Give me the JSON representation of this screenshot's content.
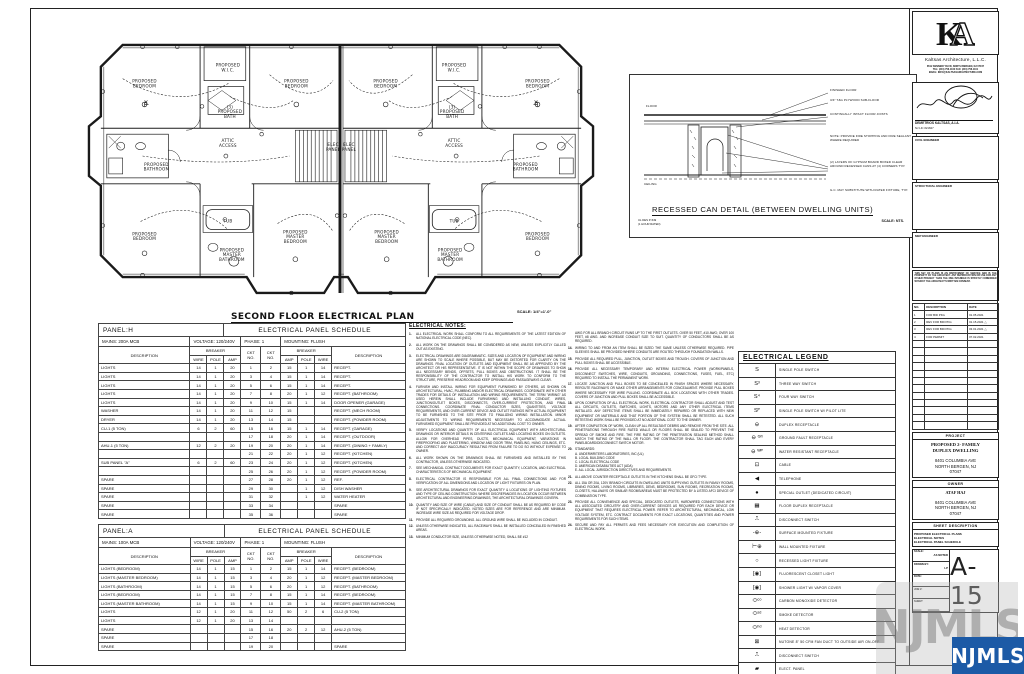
{
  "plan": {
    "title": "SECOND FLOOR ELECTRICAL PLAN",
    "scale": "SCALE: 1/4\"=1'-0\"",
    "labels": [
      {
        "t": "PROPOSED\nBEDROOM",
        "x": 62,
        "y": 66,
        "m": 1
      },
      {
        "t": "PROPOSED\nW.I.C.",
        "x": 146,
        "y": 50,
        "m": 1
      },
      {
        "t": "(3)\nPROPOSED\nBATH",
        "x": 148,
        "y": 92,
        "m": 1
      },
      {
        "t": "PROPOSED\nBEDROOM",
        "x": 215,
        "y": 66,
        "m": 1
      },
      {
        "t": "ATTIC\nACCESS",
        "x": 146,
        "y": 126,
        "m": 1
      },
      {
        "t": "PROPOSED\nBATHROOM",
        "x": 74,
        "y": 150,
        "m": 1
      },
      {
        "t": "ELEC\nPANEL",
        "x": 252,
        "y": 130,
        "m": 1
      },
      {
        "t": "PROPOSED\nBEDROOM",
        "x": 62,
        "y": 220,
        "m": 1
      },
      {
        "t": "TUB",
        "x": 146,
        "y": 207,
        "m": 1
      },
      {
        "t": "PROPOSED\nMASTER\nBATHROOM",
        "x": 150,
        "y": 236,
        "m": 1
      },
      {
        "t": "PROPOSED\nMASTER\nBEDROOM",
        "x": 214,
        "y": 218,
        "m": 1
      }
    ]
  },
  "panels": {
    "h": {
      "name": "PANEL:H",
      "title": "ELECTRICAL PANEL SCHEDULE",
      "mains": "MAINS: 200A MCB",
      "voltage": "VOLTAGE: 120/240V",
      "phase": "PHASE: 1",
      "mounting": "MOUNTING: FLUSH",
      "rows": [
        [
          "LIGHTS",
          "14",
          "1",
          "20",
          "1",
          "2",
          "15",
          "1",
          "14",
          "RECEPT."
        ],
        [
          "LIGHTS",
          "14",
          "1",
          "20",
          "3",
          "4",
          "15",
          "1",
          "14",
          "RECEPT."
        ],
        [
          "LIGHTS",
          "14",
          "1",
          "20",
          "5",
          "6",
          "15",
          "1",
          "14",
          "RECEPT."
        ],
        [
          "LIGHTS",
          "14",
          "1",
          "20",
          "7",
          "8",
          "20",
          "1",
          "12",
          "RECEPT. (BATHROOM)"
        ],
        [
          "LIGHTS",
          "14",
          "1",
          "20",
          "9",
          "10",
          "15",
          "1",
          "14",
          "DOOR OPENER (GARAGE)"
        ],
        [
          "WASHER",
          "14",
          "1",
          "20",
          "11",
          "12",
          "15",
          "",
          "",
          "RECEPT. (MECH ROOM)"
        ],
        [
          "DRYER",
          "14",
          "1",
          "20",
          "13",
          "14",
          "15",
          "",
          "",
          "RECEPT. (POWDER ROOM)"
        ],
        [
          "CU-1 (5 TON)",
          "6",
          "2",
          "60",
          "15",
          "16",
          "15",
          "1",
          "14",
          "RECEPT. (GARAGE)"
        ],
        [
          "",
          "",
          "",
          "",
          "17",
          "18",
          "20",
          "1",
          "14",
          "RECEPT. (OUTDOOR)"
        ],
        [
          "AHU-1 (5 TON)",
          "12",
          "2",
          "20",
          "19",
          "20",
          "20",
          "1",
          "14",
          "RECEPT. (DINING + FAMILY)"
        ],
        [
          "",
          "",
          "",
          "",
          "21",
          "22",
          "20",
          "1",
          "12",
          "RECEPT. (KITCHEN)"
        ],
        [
          "SUB PANEL \"A\"",
          "6",
          "2",
          "60",
          "23",
          "24",
          "20",
          "1",
          "12",
          "RECEPT. (KITCHEN)"
        ],
        [
          "",
          "",
          "",
          "",
          "25",
          "26",
          "20",
          "1",
          "12",
          "RECEPT. (POWDER ROOM)"
        ],
        [
          "SPARE",
          "",
          "",
          "",
          "27",
          "28",
          "20",
          "1",
          "12",
          "REF."
        ],
        [
          "SPARE",
          "",
          "",
          "",
          "29",
          "30",
          "",
          "1",
          "12",
          "DISH WASHER"
        ],
        [
          "SPARE",
          "",
          "",
          "",
          "31",
          "32",
          "",
          "1",
          "12",
          "WATER HEATER"
        ],
        [
          "SPARE",
          "",
          "",
          "",
          "33",
          "34",
          "",
          "",
          "",
          "SPARE"
        ],
        [
          "SPARE",
          "",
          "",
          "",
          "35",
          "36",
          "",
          "",
          "",
          "SPARE"
        ]
      ]
    },
    "a": {
      "name": "PANEL:A",
      "title": "ELECTRICAL PANEL SCHEDULE",
      "mains": "MAINS: 100A MCB",
      "voltage": "VOLTAGE: 120/240V",
      "phase": "PHASE: 1",
      "mounting": "MOUNTING: FLUSH",
      "rows": [
        [
          "LIGHTS (BEDROOM)",
          "14",
          "1",
          "15",
          "1",
          "2",
          "15",
          "1",
          "14",
          "RECEPT. (BEDROOM)"
        ],
        [
          "LIGHTS (MASTER BEDROOM)",
          "14",
          "1",
          "15",
          "3",
          "4",
          "20",
          "1",
          "12",
          "RECEPT. (MASTER BEDROOM)"
        ],
        [
          "LIGHTS (BATHROOM)",
          "14",
          "1",
          "15",
          "5",
          "6",
          "20",
          "1",
          "12",
          "RECEPT. (BATHROOM)"
        ],
        [
          "LIGHTS (BEDROOM)",
          "14",
          "1",
          "15",
          "7",
          "8",
          "15",
          "1",
          "14",
          "RECEPT. (BEDROOM)"
        ],
        [
          "LIGHTS (MASTER BATHROOM)",
          "14",
          "1",
          "15",
          "9",
          "10",
          "15",
          "1",
          "14",
          "RECEPT. (MASTER BATHROOM)"
        ],
        [
          "LIGHTS",
          "12",
          "1",
          "20",
          "11",
          "12",
          "50",
          "2",
          "6",
          "CU-2 (5 TON)"
        ],
        [
          "LIGHTS",
          "12",
          "1",
          "20",
          "13",
          "14",
          "",
          "",
          "",
          ""
        ],
        [
          "SPARE",
          "",
          "",
          "",
          "15",
          "16",
          "20",
          "2",
          "12",
          "AHU-2 (5 TON)"
        ],
        [
          "SPARE",
          "",
          "",
          "",
          "17",
          "18",
          "",
          "",
          "",
          ""
        ],
        [
          "SPARE",
          "",
          "",
          "",
          "19",
          "20",
          "",
          "",
          "",
          "SPARE"
        ]
      ]
    },
    "col_headers": {
      "description": "DESCRIPTION",
      "breaker": "BREAKER",
      "ckt": "CKT\nNO.",
      "wire": "WIRE",
      "pole": "POLE",
      "amp": "AMP"
    }
  },
  "notes": {
    "heading": "ELECTRICAL NOTES:",
    "col1": [
      {
        "n": "1.",
        "t": "ALL ELECTRICAL WORK SHALL CONFORM TO ALL REQUIREMENTS OF THE LATEST EDITION OF NATIONAL ELECTRICAL CODE (NEC)."
      },
      {
        "n": "2.",
        "t": "ALL WORK ON THE DRAWINGS SHALL BE CONSIDERED AS NEW, UNLESS EXPLICITLY CALLED OUT AS EXISTING."
      },
      {
        "n": "3.",
        "t": "ELECTRICAL DRAWINGS ARE DIAGRAMMATIC. SIZES AND LOCATION OF EQUIPMENT AND WIRING ARE SHOWN TO SCALE WHERE POSSIBLE, BUT MAY BE DISTORTED FOR CLARITY ON THE DRAWINGS. FINAL LOCATION OF OUTLETS AND EQUIPMENT SHALL BE AS APPROVED BY THE ARCHITECT OR HIS REPRESENTATIVE. IT IS NOT WITHIN THE SCOPE OF DRAWINGS TO SHOW ALL NECESSARY BENDS, OFFSETS, PULL BOXES AND OBSTRUCTIONS. IT SHALL BE THE RESPONSIBILITY OF THE CONTRACTOR TO INSTALL HIS WORK TO CONFORM TO THE STRUCTURE, PRESERVE HEADROOM AND KEEP OPENINGS AND PASSAGEWAYS CLEAR."
      },
      {
        "n": "4.",
        "t": "FURNISH AND INSTALL WIRING FOR EQUIPMENT FURNISHED BY OTHERS, AS SHOWN ON ARCHITECTURAL, HVAC, PLUMBING AND/OR ELECTRICAL DRAWINGS. COORDINATE WITH OTHER TRADES FOR DETAILS OF INSTALLATION AND WIRING REQUIREMENTS. THE TERM \"WIRING\" AS USED HEREIN SHALL INCLUDE FURNISHING AND INSTALLING CONDUIT, WIRES, JUNCTION/OUTLET BOXES, DISCONNECTS, OVER-CURRENT PROTECTION, AND FINAL CONNECTIONS. COORDINATE FINAL CONDUCTOR SIZES, QUANTITIES, VOLTAGE REQUIREMENTS, AND OVER-CURRENT DEVICE AND OUTLET RATINGS WITH ACTUAL EQUIPMENT TO BE FURNISHED TO THE SITE PRIOR TO FINALIZING WIRING INSTALLATION. MINOR ADJUSTMENTS TO WIRING REQUIREMENTS NECESSARY TO ACCOMMODATE ACTUAL FURNISHED EQUIPMENT SHALL BE PROVIDED AT NO ADDITIONAL COST TO OWNER."
      },
      {
        "n": "5.",
        "t": "VERIFY LOCATIONS AND QUANTITY OF ALL ELECTRICAL EQUIPMENT WITH ARCHITECTURAL DRAWINGS OR INTERIOR DETAILS IN CENTERING OUTLETS AND LOCATING BOXES ON OUTLETS. ALLOW FOR OVERHEAD PIPES, DUCTS, MECHANICAL EQUIPMENT, VARIATIONS IN FIREPROOFING AND PLASTERING, WINDOW AND DOOR TRIM, PANELING, HUNG CEILINGS, ETC. AND CORRECT ANY INACCURACY RESULTING FROM FAILURE TO DO SO WITHOUT EXPENSE TO OWNER."
      },
      {
        "n": "6.",
        "t": "ALL WORK SHOWN ON THE DRAWINGS SHALL BE FURNISHED AND INSTALLED BY THIS CONTRACTOR, UNLESS OTHERWISE INDICATED."
      },
      {
        "n": "7.",
        "t": "SEE MECHANICAL CONTRACT DOCUMENTS FOR EXACT QUANTITY, LOCATION, AND ELECTRICAL CHARACTERISTICS OF MECHANICAL EQUIPMENT."
      },
      {
        "n": "8.",
        "t": "ELECTRICAL CONTRACTOR IS RESPONSIBLE FOR ALL FINAL CONNECTIONS AND FOR VERIFICATION OF ALL DIMENSIONS AND LOCATION OF LIGHT FIXTURES ON PLAN."
      },
      {
        "n": "9.",
        "t": "SEE ARCHITECTURAL DRAWINGS FOR EXACT QUANTITY & LOCATIONS OF LIGHTING FIXTURES AND TYPE OF CEILING CONSTRUCTION. WHERE DISCREPANCIES IN LOCATION OCCUR BETWEEN ARCHITECTURAL AND ENGINEERING DRAWINGS, THE ARCHITECTURAL DRAWINGS GOVERN."
      },
      {
        "n": "10.",
        "t": "QUANTITY AND SIZE OF WIRE (CABLE) AND SIZE OF CONDUIT SHALL BE AS REQUIRED BY CODE IF NOT SPECIFICALLY INDICATED. NOTED SIZES ARE FOR REFERENCE AND ARE MINIMUM. INCREASE WIRE SIZE AS REQUIRED FOR VOLTAGE DROP."
      },
      {
        "n": "11.",
        "t": "PROVIDE ALL REQUIRED GROUNDING. ALL GROUND WIRE SHALL BE INCLUDED IN CONDUIT."
      },
      {
        "n": "12.",
        "t": "UNLESS OTHERWISE INDICATED, ALL RACEWAYS SHALL BE INSTALLED CONCEALED IN FINISHED AREAS."
      },
      {
        "n": "13.",
        "t": "MINIMUM CONDUCTOR SIZE, UNLESS OTHERWISE NOTED, SHALL BE #12"
      }
    ],
    "col2": [
      {
        "n": "",
        "t": "AWG FOR ALL BRANCH CIRCUIT RUNS UP TO THE FIRST OUTLETS. OVER 50 FEET, #10 AWG; OVER 100 FEET, #8 AWG. AND INCREASE CONDUIT SIZE TO SUIT. QUANTITY OF CONDUCTORS SHALL BE AS REQUIRED."
      },
      {
        "n": "14.",
        "t": "WIRING TO AND FROM AN ITEM SHALL BE SIZED THE SAME UNLESS OTHERWISE REQUIRED. PIPE SLEEVES SHALL BE PROVIDED WHERE CONDUITS ARE ROUTED THROUGH FOUNDATION WALLS."
      },
      {
        "n": "15.",
        "t": "PROVIDE ALL REQUIRED PULL, JUNCTION, OUTLET BOXES AND TROUGH. COVERS OF JUNCTION AND PULL BOXES SHALL BE ACCESSIBLE."
      },
      {
        "n": "16.",
        "t": "PROVIDE ALL NECESSARY TEMPORARY AND INTERIM ELECTRICAL POWER (WORK/PANELS, DISCONNECT SWITCHES, WIRE, CONDUITS, GROUNDING, CONNECTIONS, FUSES, FUEL, ETC) REQUIRED TO INSTALL THE PERMANENT WORK."
      },
      {
        "n": "17.",
        "t": "LOCATE JUNCTION AND PULL BOXES TO BE CONCEALED IN FINISH SPACES WHERE NECESSARY. REROUTE RACEWAYS OR MAKE OTHER ARRANGEMENTS FOR CONCEALMENT. PROVIDE PULL BOXES WHERE NECESSARY FOR WIRE PULLING. COORDINATE ALL BOX LOCATIONS WITH OTHER TRADES. COVERS OF JUNCTION AND PULL BOXES SHALL BE ACCESSIBLE."
      },
      {
        "n": "18.",
        "t": "UPON COMPLETION OF ALL ELECTRICAL WORK, ELECTRICAL CONTRACTOR SHALL ADJUST AND TEST ALL CIRCUITS, OUTLETS, SWITCHES, LIGHTS, MOTORS AND ANY OTHER ELECTRICAL ITEMS INSTALLED. ANY DEFECTIVE ITEMS SHALL BE IMMEDIATELY REPAIRED OR REPLACED WITH NEW EQUIPMENT OR MATERIALS AND THAT PORTION OF THE SYSTEM SHALL BE RETESTED. ALL SUCH RETESTING WORK SHALL BE PROVIDED AT NO ADDITIONAL COST TO THE OWNER."
      },
      {
        "n": "19.",
        "t": "AFTER COMPLETION OF WORK, CLEAN UP ALL RESULTANT DEBRIS AND REMOVE FROM THE SITE. ALL PENETRATIONS THROUGH FIRE RATED WALLS OR FLOORS SHALL BE SEALED TO PREVENT THE SPREAD OF SMOKE AND FIRE. THE FIRE RATING OF THE PENETRATION SEALING METHOD SHALL MATCH THE RATING OF THE WALL OR FLOOR. THE CONTRACTOR SHALL TAG EACH AND EVERY PANELBOARD/DISCONNECT SWITCH MOTOR."
      },
      {
        "n": "20.",
        "t": "STANDARDS:\nA. UNDERWRITERS LABORATORIES, INC (UL)\nB. LOCAL BUILDING CODE\nC. LOCAL ELECTRICAL CODE\nD. AMERICAN DISABILITIES ACT (ADA)\nE. ALL LOCAL JURISDICTION DIRECTIVES AND REQUIREMENTS."
      },
      {
        "n": "21.",
        "t": "ALL ABOVE COUNTER RECEPTACLE OUTLETS IN THE KITCHENS SHALL BE GFCI TYPE."
      },
      {
        "n": "22.",
        "t": "ALL 15A OR 20A, 120V BRANCH CIRCUITS IN DWELLING UNITS SUPPLYING OUTLETS IN FAMILY ROOMS, DINING ROOMS, LIVING ROOMS, LIBRARIES, DENS, BEDROOMS, SUN ROOMS, RECREATION ROOMS, CLOSETS, HALLWAYS OR SIMILAR ROOMS/AREAS MUST BE PROTECTED BY A LISTED AFCI DEVICE OF COMBINATION TYPE."
      },
      {
        "n": "23.",
        "t": "PROVIDE ALL CONVENIENCE AND SPECIAL, DEDICATED OUTLETS, HARDWIRED CONNECTIONS WITH ALL ASSOCIATED CIRCUITRY AND OVER-CURRENT DEVICES AS REQUIRED FOR EACH DEVICE OR EQUIPMENT THAT REQUIRES ELECTRICAL POWER. REFER TO ARCHITECTURAL, MECHANICAL, LOW VOLTAGE SYSTEM, ETC. CONTRACT DOCUMENTS FOR EXACT LOCATIONS, QUANTITIES AND POWER REQUIREMENTS FOR SUCH ITEMS."
      },
      {
        "n": "24.",
        "t": "SECURE AND PAY ALL PERMITS AND FEES NECESSARY FOR EXECUTION AND COMPLETION OF ELECTRICAL WORK."
      }
    ]
  },
  "legend": {
    "title": "ELECTRICAL LEGEND",
    "items": [
      {
        "sym": "S",
        "label": "SINGLE POLE SWITCH"
      },
      {
        "sym": "S³",
        "label": "THREE WAY SWITCH"
      },
      {
        "sym": "S⁴",
        "label": "FOUR WAY SWITCH"
      },
      {
        "sym": "Sᴾ",
        "label": "SINGLE POLE SWITCH W/ PILOT LITE"
      },
      {
        "sym": "⊖",
        "label": "DUPLEX RECEPTACLE"
      },
      {
        "sym": "⊖ ᴳᶠᴵ",
        "label": "GROUND FAULT RECEPTACLE"
      },
      {
        "sym": "⊖ ᵂᴾ",
        "label": "WATER RESISTANT RECEPTACLE"
      },
      {
        "sym": "⊡",
        "label": "CABLE"
      },
      {
        "sym": "◀",
        "label": "TELEPHONE"
      },
      {
        "sym": "●",
        "label": "SPECIAL OUTLET (DEDICATED CIRCUIT)"
      },
      {
        "sym": "▦",
        "label": "FLOOR DUPLEX RECEPTACLE"
      },
      {
        "sym": "⎍",
        "label": "DISCONNECT SWITCH"
      },
      {
        "sym": "-⊕-",
        "label": "SURFACE MOUNTED FIXTURE"
      },
      {
        "sym": "⊢⊕",
        "label": "WALL MOUNTED FIXTURE"
      },
      {
        "sym": "○",
        "label": "RECESSED LIGHT FIXTURE"
      },
      {
        "sym": "[◉]",
        "label": "FLUORESCENT CLOSET LIGHT"
      },
      {
        "sym": "[◉]",
        "label": "SHOWER LIGHT W/ VAPOR COVER"
      },
      {
        "sym": "⬭ᶜᵒ",
        "label": "CARBON MONOXIDE DETECTOR"
      },
      {
        "sym": "⬭ˢᵈ",
        "label": "SMOKE DETECTOR"
      },
      {
        "sym": "⬭ʰᵈ",
        "label": "HEAT DETECTOR"
      },
      {
        "sym": "⊠",
        "label": "NUTONE 8\" 50 CFM FAN DUCT TO OUTSIDE AIR ON-OFF"
      },
      {
        "sym": "⎍",
        "label": "DISCONNECT SWITCH"
      },
      {
        "sym": "▰",
        "label": "ELECT. PANEL"
      }
    ]
  },
  "detail": {
    "title": "RECESSED CAN DETAIL (BETWEEN DWELLING UNITS)",
    "scale": "SCALE: NTS.",
    "ul_note": "UL DES P-549\n(1 HOUR RATED)",
    "callouts": [
      {
        "t": "FINISHED FLOOR",
        "x": 200,
        "y": 14,
        "w": 82
      },
      {
        "t": "3/4\" T&G PLYWOOD SUB-FLOOR",
        "x": 200,
        "y": 24,
        "w": 82
      },
      {
        "t": "CONTINUALLY INTACT FLOOR JOISTS",
        "x": 200,
        "y": 38,
        "w": 82
      },
      {
        "t": "NOTE: PROVIDE FIRE STOPPING AND FIRE SEALANT WHERE REQUIRED",
        "x": 200,
        "y": 60,
        "w": 82
      },
      {
        "t": "(2) LAYERS OF GYPSUM BOARD BOXED CLEAR AROUND RECESSED CANS AT (4) CORNERS TYP.",
        "x": 200,
        "y": 86,
        "w": 82
      },
      {
        "t": "G.C. MAY SUBSTITUTE WITH RATED FIXTURE, TYP.",
        "x": 200,
        "y": 114,
        "w": 82
      },
      {
        "t": "FLOOR",
        "x": 16,
        "y": 30,
        "w": 30
      },
      {
        "t": "CEILING",
        "x": 14,
        "y": 108,
        "w": 30
      }
    ]
  },
  "titleblock": {
    "firm": "Kaltsas Architecture, L.L.C.",
    "contact": "8512 KENNEDY BLVD, NORTH BERGEN, NJ 07047\nTEL: (201) 758-1100   FAX: (201) 758-1101\nEMAIL: INFO@KALTSASARCHITECTURE.COM",
    "architect": "DEMETRIOS KALTSAS, A.I.A.",
    "architect_lic": "NJ LIC #21847",
    "civil": "CIVIL ENGINEER",
    "structural": "STRUCTURAL ENGINEER",
    "mep": "MEP ENGINEER",
    "copyright": "THIS SET OF PLANS IS AN INSTRUMENT OF SERVICE AND IS THE PROPERTY OF THE ARCHITECT. ANY REPRODUCTION OR USE FOR ANY OTHER PROJECT THAN THE ONE INTENDED IS STRICTLY FORBIDDEN WITHOUT THE ARCHITECT'S WRITTEN CONSENT.",
    "revisions": {
      "headers": [
        "NO.",
        "DESCRIPTION",
        "DATE"
      ],
      "rows": [
        [
          "1",
          "FOR BID PKG",
          "01.05.2021"
        ],
        [
          "2",
          "REV FOR BID PKG",
          "01.15.2021 △"
        ],
        [
          "3",
          "REV FOR BID PKG",
          "03.01.2021 △"
        ],
        [
          "4",
          "FOR PERMIT",
          "07.02.2021"
        ]
      ],
      "empty_rows": 12
    },
    "project_label": "PROJECT",
    "project_name": "PROPOSED 2- FAMILY\nDUPLEX DWELLING",
    "project_addr": "8401 COLUMBIA AVE\nNORTH BERGEN, NJ\n07047",
    "owner_label": "OWNER",
    "owner_name": "ATAF HAJ",
    "owner_addr": "8401 COLUMBIA AVE\nNORTH BERGEN, NJ\n07047",
    "sheetdesc_label": "SHEET DESCRIPTION",
    "sheetdesc": "PROPOSED ELECTRICAL PLANS\nELECTRICAL NOTES\nELECTRICAL PANEL SCHEDULE",
    "scale_label": "SCALE:",
    "scale_value": "AS NOTED",
    "drawn_label": "DRAWN BY:",
    "drawn_value": "LP",
    "date_label": "DATE:",
    "date_value": "",
    "job_label": "JOB #:",
    "job_value": "",
    "sheet_label": "SHEET",
    "sheet_number": "A-15"
  },
  "watermark": {
    "badge": "NJMLS",
    "ghost": "NJMLS",
    "badge_color": "#1c5aa6"
  }
}
